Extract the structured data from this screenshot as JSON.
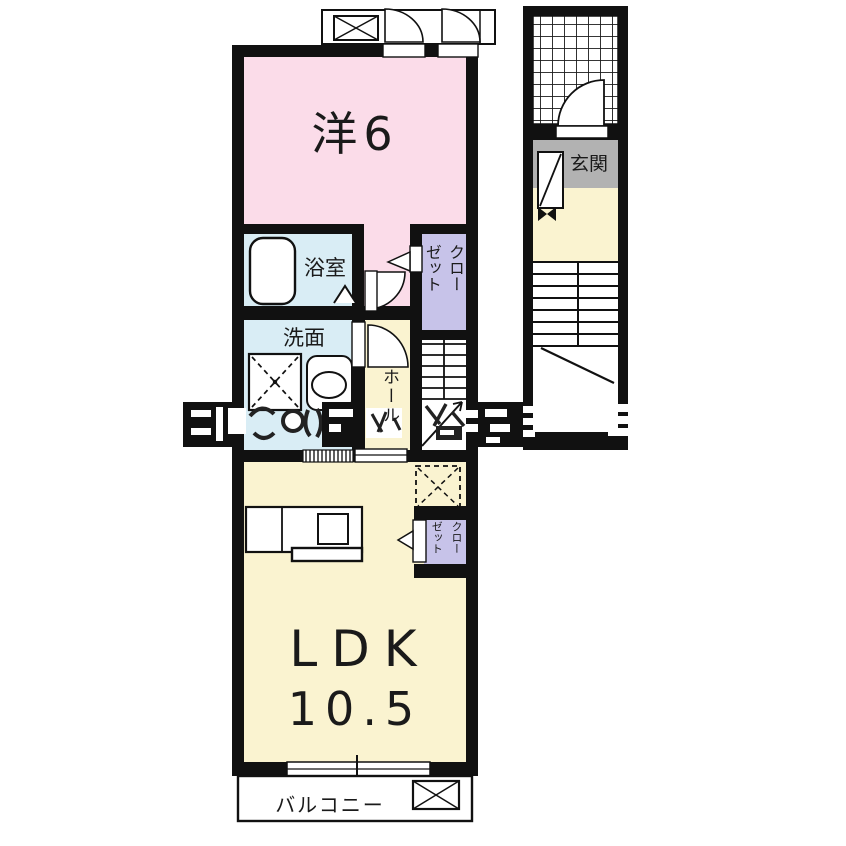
{
  "plan": {
    "type": "apartment-floor-plan",
    "colors": {
      "wall": "#111111",
      "western_room": "#fbdce9",
      "wet_area": "#d9edf5",
      "closet": "#c7c3e9",
      "hall_ldk": "#faf3d0",
      "entrance_floor": "#b2b2b2",
      "paper": "#ffffff"
    },
    "rooms": {
      "western": {
        "label": "洋6"
      },
      "bathroom": {
        "label": "浴室"
      },
      "washroom": {
        "label": "洗面"
      },
      "hall": {
        "label": "ホール"
      },
      "closet_bedroom": {
        "line1": "クロー",
        "line2": "ゼット"
      },
      "closet_ldk": {
        "line1": "クロー",
        "line2": "ゼット"
      },
      "ldk": {
        "label": "LDK",
        "size": "10.5"
      },
      "balcony": {
        "label": "バルコニー"
      },
      "entrance": {
        "label": "玄関"
      }
    }
  }
}
